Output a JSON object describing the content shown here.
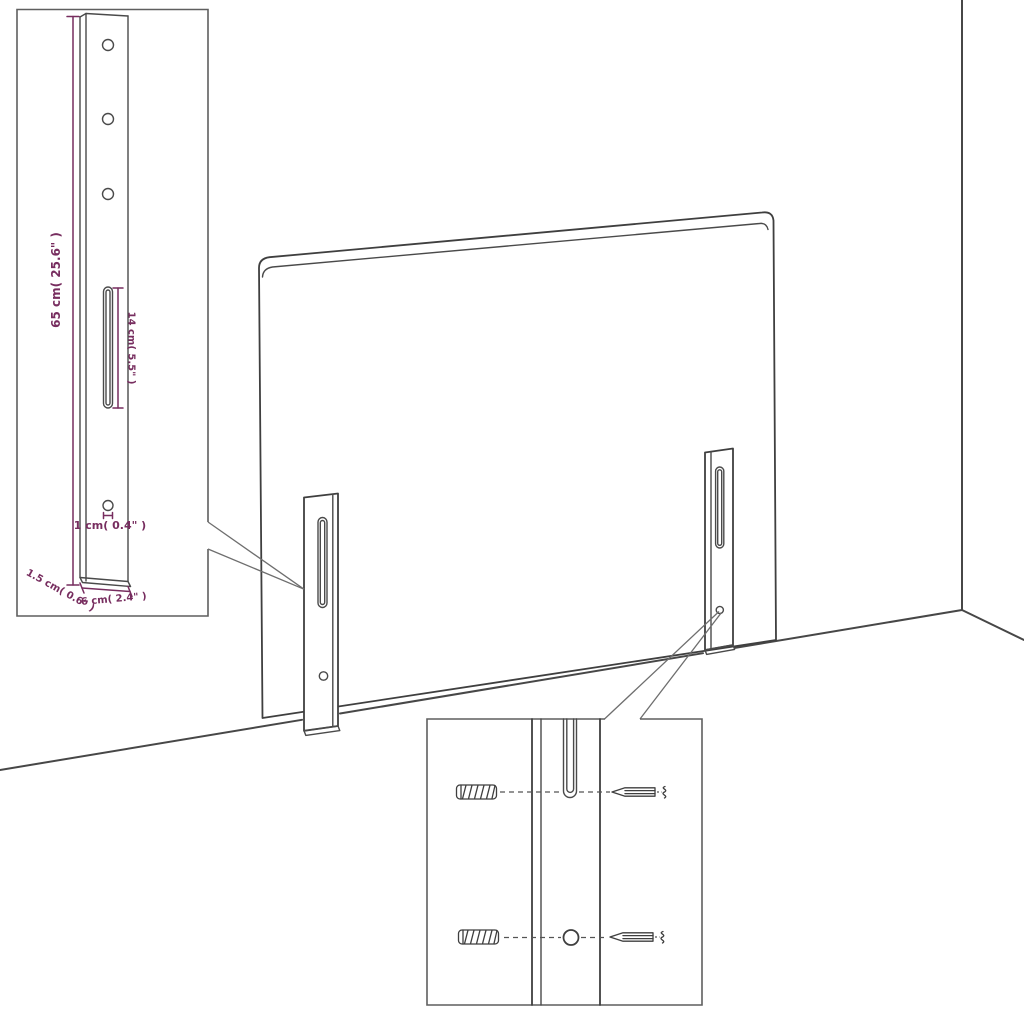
{
  "colors": {
    "background": "#ffffff",
    "line": "#3f3f3f",
    "dimension": "#772d5f"
  },
  "leg_detail_inset": {
    "dim_total_height": "65 cm( 25.6\" )",
    "dim_slot_length": "14 cm( 5.5\" )",
    "dim_hole_diameter": "1 cm( 0.4\" )",
    "dim_thickness": "1.5 cm( 0.6\" )",
    "dim_width": "6 cm( 2.4\" )"
  },
  "mounting_detail_inset": {
    "hardware": {
      "anchor": "wall-plug-icon",
      "screw": "screw-icon",
      "hole": "mounting-hole",
      "slot": "keyhole-slot"
    }
  }
}
